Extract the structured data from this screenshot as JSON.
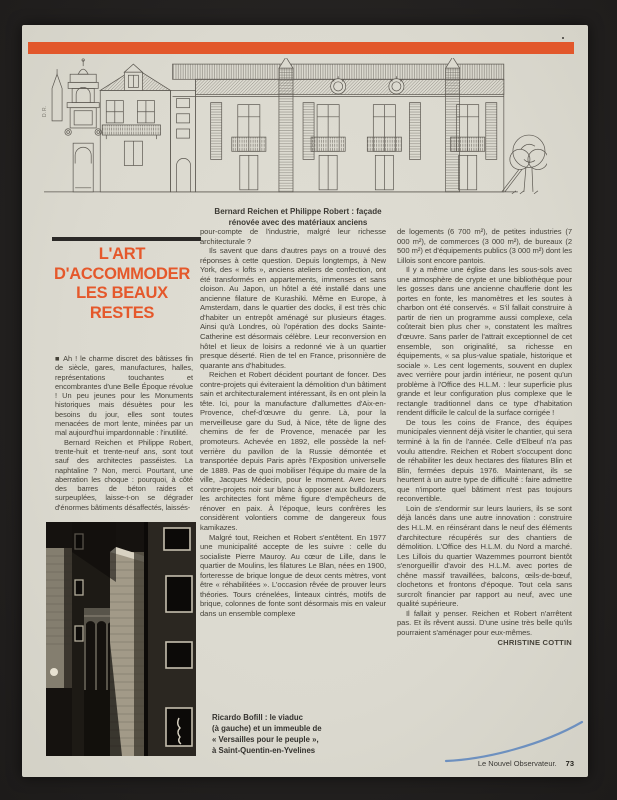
{
  "colors": {
    "accent_orange": "#e2572b",
    "page_background": "#dbd9cf",
    "backdrop": "#232120",
    "pen_blue": "#5b84bd"
  },
  "facade": {
    "credit": "D.R.",
    "caption_line1": "Bernard Reichen et Philippe Robert : façade",
    "caption_line2": "rénovée avec des matériaux anciens"
  },
  "title": {
    "lines": [
      "L'ART",
      "D'ACCOMMODER",
      "LES BEAUX",
      "RESTES"
    ]
  },
  "article": {
    "col1": [
      "■ Ah ! le charme discret des bâtisses fin de siècle, gares, manufactures, halles, représentations touchantes et encombrantes d'une Belle Époque révolue ! Un peu jeunes pour les Monuments historiques mais désuètes pour les besoins du jour, elles sont toutes menacées de mort lente, minées par un mal aujourd'hui impardonnable : l'inutilité.",
      "Bernard Reichen et Philippe Robert, trente-huit et trente-neuf ans, sont tout sauf des architectes passéistes. La naphtaline ? Non, merci. Pourtant, une aberration les choque : pourquoi, à côté des barres de béton raides et surpeuplées, laisse-t-on se dégrader d'énormes bâtiments désaffectés, laissés-"
    ],
    "col2": [
      "pour-compte de l'industrie, malgré leur richesse architecturale ?",
      "Ils savent que dans d'autres pays on a trouvé des réponses à cette question. Depuis longtemps, à New York, des « lofts », anciens ateliers de confection, ont été transformés en appartements, immenses et sans cloison. Au Japon, un hôtel a été installé dans une ancienne filature de Kurashiki. Même en Europe, à Amsterdam, dans le quartier des docks, il est très chic d'habiter un entrepôt aménagé sur plusieurs étages. Ainsi qu'à Londres, où l'opération des docks Sainte-Catherine est désormais célèbre. Leur reconversion en hôtel et lieux de loisirs a redonné vie à un quartier presque déserté. Rien de tel en France, prisonnière de quarante ans d'habitudes.",
      "Reichen et Robert décident pourtant de foncer. Des contre-projets qui éviteraient la démolition d'un bâtiment sain et architecturalement intéressant, ils en ont plein la tête. Ici, pour la manufacture d'allumettes d'Aix-en-Provence, chef-d'œuvre du genre. Là, pour la merveilleuse gare du Sud, à Nice, tête de ligne des chemins de fer de Provence, menacée par les promoteurs. Achevée en 1892, elle possède la nef-verrière du pavillon de la Russie démontée et transportée depuis Paris après l'Exposition universelle de 1889. Pas de quoi mobiliser l'équipe du maire de la ville, Jacques Médecin, pour le moment. Avec leurs contre-projets noir sur blanc à opposer aux bulldozers, les architectes font même figure d'empêcheurs de rénover en paix. À l'époque, leurs confrères les considèrent volontiers comme de dangereux fous kamikazes.",
      "Malgré tout, Reichen et Robert s'entêtent. En 1977 une municipalité accepte de les suivre : celle du socialiste Pierre Mauroy. Au cœur de Lille, dans le quartier de Moulins, les filatures Le Blan, nées en 1900, forteresse de brique longue de deux cents mètres, vont être « réhabilitées ». L'occasion rêvée de prouver leurs théories. Tours crénelées, linteaux cintrés, motifs de brique, colonnes de fonte sont désormais mis en valeur dans un ensemble complexe"
    ],
    "col3": [
      "de logements (6 700 m²), de petites industries (7 000 m²), de commerces (3 000 m²), de bureaux (2 500 m²) et d'équipements publics (3 000 m²) dont les Lillois sont encore pantois.",
      "Il y a même une église dans les sous-sols avec une atmosphère de crypte et une bibliothèque pour les gosses dans une ancienne chaufferie dont les portes en fonte, les manomètres et les soutes à charbon ont été conservés. « S'il fallait construire à partir de rien un programme aussi complexe, cela coûterait bien plus cher », constatent les maîtres d'œuvre. Sans parler de l'attrait exceptionnel de cet ensemble, son originalité, sa richesse en équipements, « sa plus-value spatiale, historique et sociale ». Les cent logements, souvent en duplex avec verrière pour jardin intérieur, ne posent qu'un problème à l'Office des H.L.M. : leur superficie plus grande et leur configuration plus complexe que le rectangle traditionnel dans ce type d'habitation rendent difficile le calcul de la surface corrigée !",
      "De tous les coins de France, des équipes municipales viennent déjà visiter le chantier, qui sera terminé à la fin de l'année. Celle d'Elbeuf n'a pas voulu attendre. Reichen et Robert s'occupent donc de réhabiliter les deux hectares des filatures Blin et Blin, fermées depuis 1976. Maintenant, ils se heurtent à un autre type de difficulté : faire admettre que n'importe quel bâtiment n'est pas toujours reconvertible.",
      "Loin de s'endormir sur leurs lauriers, ils se sont déjà lancés dans une autre innovation : construire des H.L.M. en réinsérant dans le neuf des éléments d'architecture récupérés sur des chantiers de démolition. L'Office des H.L.M. du Nord a marché. Les Lillois du quartier Wazemmes pourront bientôt s'enorgueillir d'avoir des H.L.M. avec portes de chêne massif travaillées, balcons, œils-de-bœuf, clochetons et frontons d'époque. Tout cela sans surcroît financier par rapport au neuf, avec une qualité supérieure.",
      "Il fallait y penser. Reichen et Robert n'arrêtent pas. Et ils rêvent aussi. D'une usine très belle qu'ils pourraient s'aménager pour eux-mêmes."
    ],
    "byline": "CHRISTINE COTTIN"
  },
  "photo_caption": {
    "line1": "Ricardo Bofill : le viaduc",
    "line2": "(à gauche) et un immeuble de",
    "line3": "« Versailles pour le peuple »,",
    "line4": "à Saint-Quentin-en-Yvelines"
  },
  "footer": {
    "magazine": "Le Nouvel Observateur.",
    "page_number": "73"
  }
}
